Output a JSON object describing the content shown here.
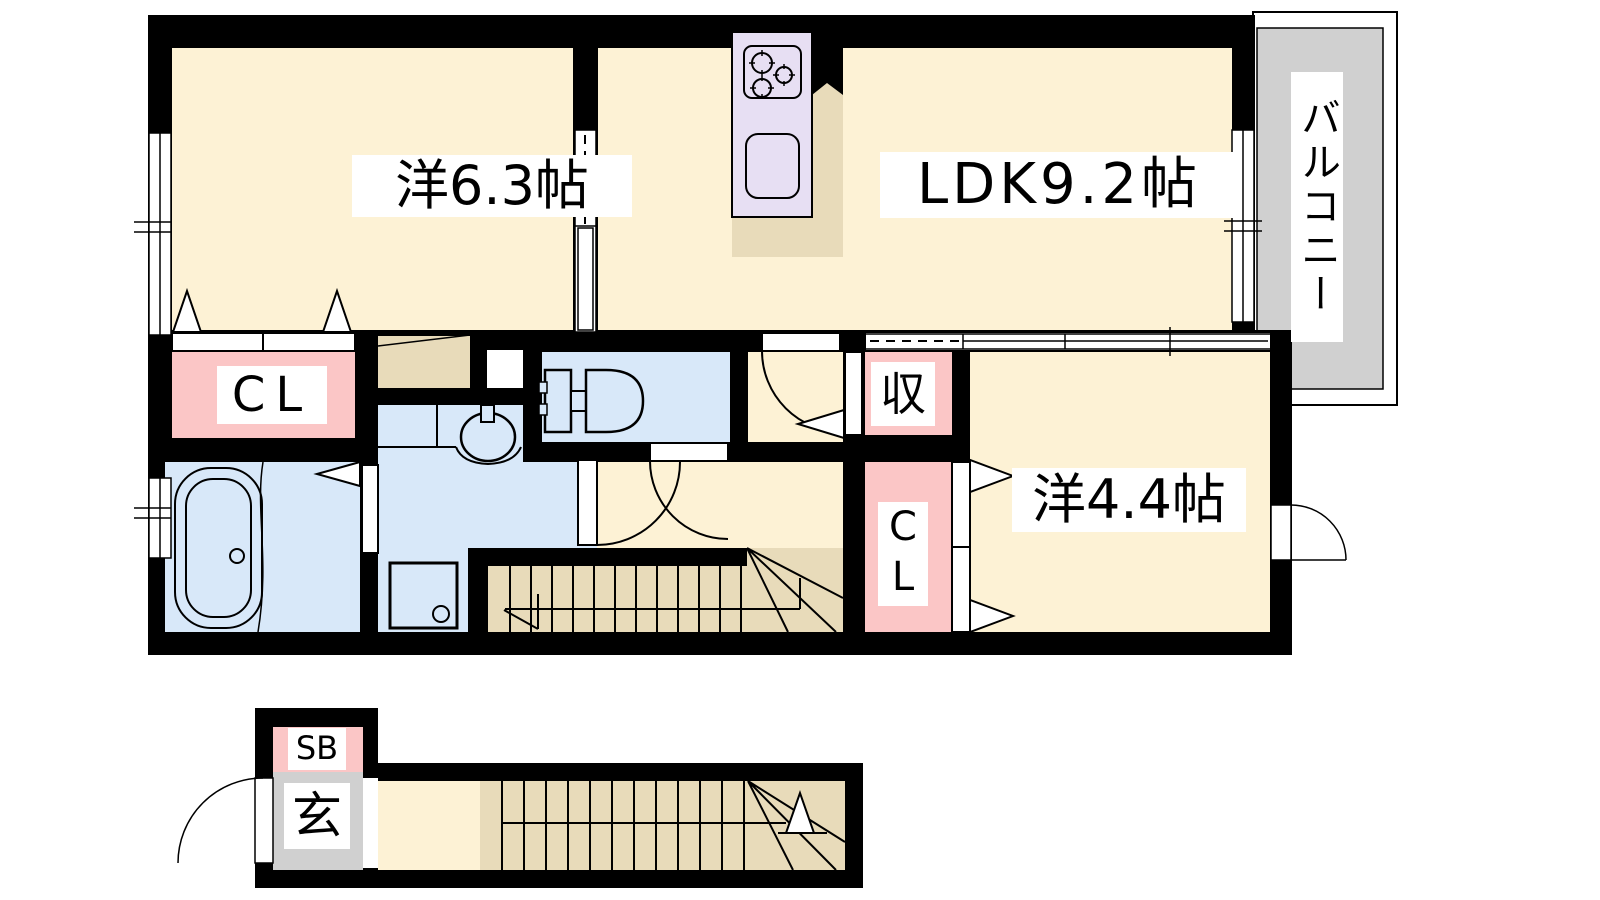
{
  "rooms": {
    "west63": {
      "label": "洋6.3帖"
    },
    "ldk": {
      "label": "LDK9.2帖"
    },
    "west44": {
      "label": "洋4.4帖"
    },
    "closet_main": {
      "label": "CL"
    },
    "storage": {
      "label": "収"
    },
    "closet_small": {
      "label": "CL"
    },
    "balcony": {
      "label": "バルコニー"
    },
    "shoebox": {
      "label": "SB"
    },
    "entrance": {
      "label": "玄"
    }
  },
  "colors": {
    "wall": "#000000",
    "floor_cream": "#fdf2d5",
    "floor_tan": "#e8dbba",
    "water_blue": "#d8e8f9",
    "closet_pink": "#fbc6c6",
    "kitchen_lavender": "#e7dff3",
    "balcony_gray": "#d0d0d0",
    "label_bg": "#ffffff"
  }
}
